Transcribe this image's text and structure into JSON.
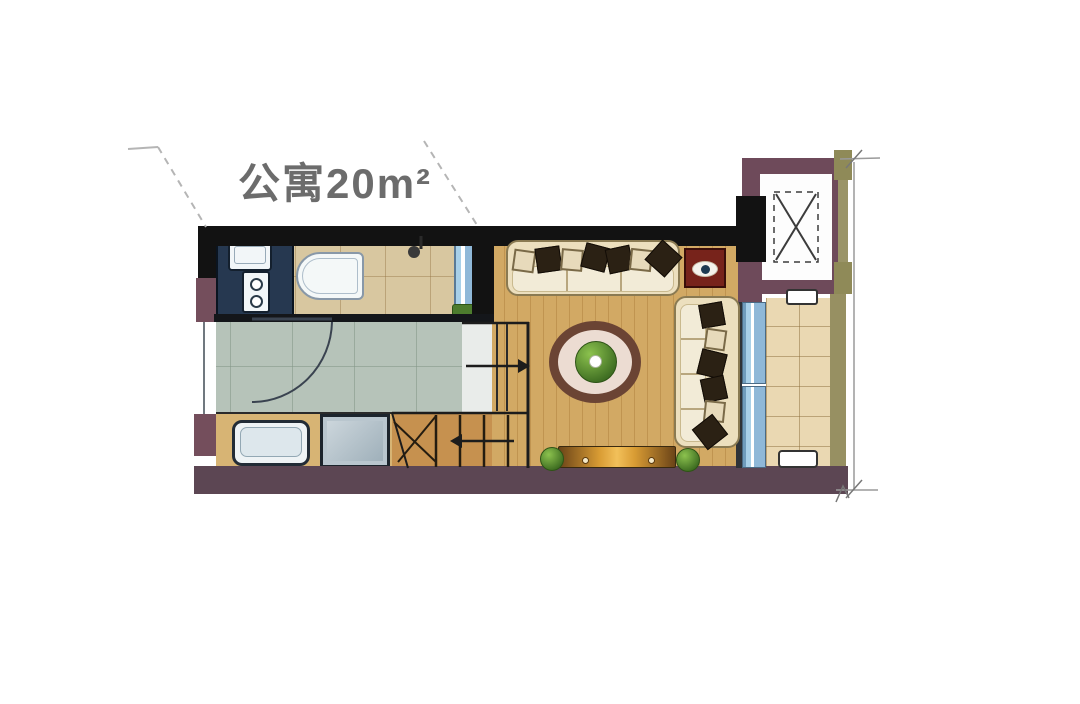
{
  "title": {
    "text": "公寓20m²"
  },
  "palette": {
    "wall_dark": "#121212",
    "wall_purple": "#6e4a5a",
    "wall_maroon": "#5c4653",
    "wall_olive": "#979062",
    "wood_floor": "#d2a964",
    "bath_tile": "#d8c7a0",
    "entry_tile": "#b6c3b9",
    "balcony_tile": "#ead8b2",
    "glass_blue": "#8fb8d8",
    "sofa_cream": "#ecdfbe",
    "rug_ring": "#6b4434",
    "accent_red_table": "#77231b",
    "plant_green": "#3f6e22",
    "annotation_gray": "#9a9a9a"
  },
  "icons": {
    "elevator_symbol": "x-in-dashed-rect",
    "shower_head_icon": "stem-with-circle",
    "door_swing_icon": "quarter-arc",
    "stairs_up_arrow": "arrow-right",
    "stairs_down_arrow": "arrow-left"
  }
}
